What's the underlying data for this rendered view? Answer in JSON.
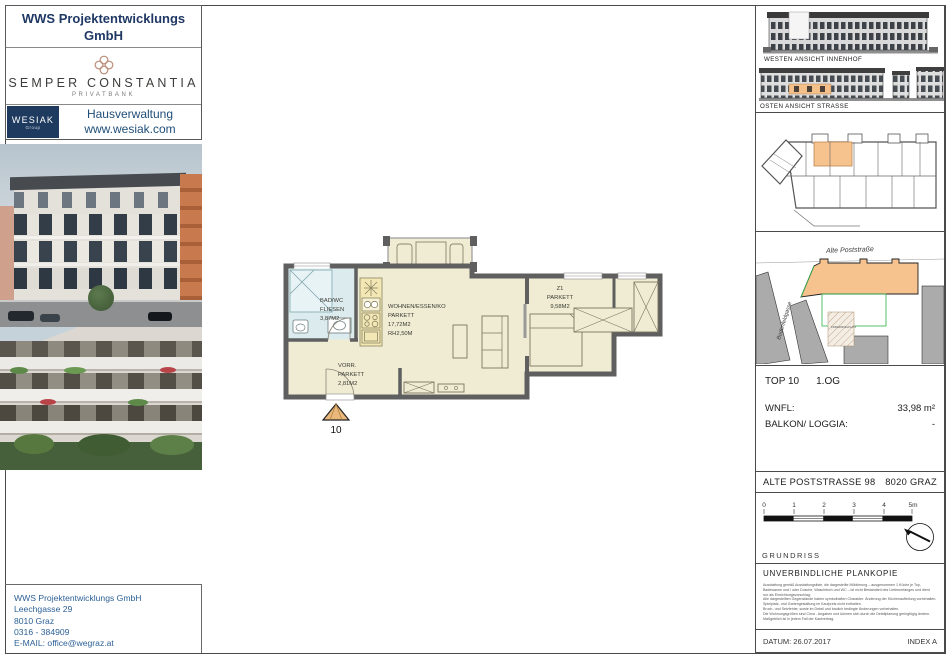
{
  "branding": {
    "wws": [
      "WWS Projektentwicklungs",
      "GmbH"
    ],
    "semper": {
      "name": "SEMPER CONSTANTIA",
      "sub": "PRIVATBANK"
    },
    "wesiak": {
      "box_line1": "WESIAK",
      "box_line2": "Group",
      "line1": "Hausverwaltung",
      "line2": "www.wesiak.com"
    }
  },
  "contact": {
    "lines": [
      "WWS Projektentwicklungs GmbH",
      "Leechgasse 29",
      "8010 Graz",
      "0316 - 384909",
      "E-MAIL: office@wegraz.at"
    ]
  },
  "plan": {
    "living": [
      "WOHNEN/ESSEN/KO",
      "PARKETT",
      "17,72M2",
      "RH2,50M"
    ],
    "room1": [
      "Z1",
      "PARKETT",
      "9,58M2"
    ],
    "bath": [
      "BAD/WC",
      "FLIESEN",
      "3,87M2"
    ],
    "hall": [
      "VORR.",
      "PARKETT",
      "2,81M2"
    ],
    "unit_number": "10"
  },
  "sidebar": {
    "elevation_west_label": "WESTEN ANSICHT INNENHOF",
    "elevation_east_label": "OSTEN ANSICHT STRASSE",
    "siteplan": {
      "street_top": "Alte Poststraße",
      "street_left": "Bodenfeldgasse",
      "playground": "KINDERSPIELPLATZ"
    },
    "unit_info": {
      "top_label": "TOP 10",
      "floor_label": "1.OG",
      "wnfl_label": "WNFL:",
      "wnfl_value": "33,98 m²",
      "balcony_label": "BALKON/ LOGGIA:",
      "balcony_value": "-"
    },
    "project_address": {
      "street": "ALTE POSTSTRASSE 98",
      "city": "8020 GRAZ"
    },
    "scalebar": {
      "labels": [
        "0",
        "1",
        "2",
        "3",
        "4",
        "5m"
      ],
      "drawing_type": "GRUNDRISS"
    },
    "disclaimer": {
      "title": "UNVERBINDLICHE PLANKOPIE",
      "lines": [
        "Ausstattung gemäß Ausstattungsliste, die dargestellte Möblierung – ausgenommen 1 Küche je Top,",
        "Badewanne und / oder Dusche, Waschtisch und WC – ist nicht Bestandteil des Lieferumfanges und dient",
        "nur als Einrichtungsvorschlag.",
        "Alle dargestellten Gegenstände haben symbolhaften Charakter. Änderung der Küchenaufteilung vorbehalten.",
        "Spielplatz- und Gartengestaltung im Kaufpreis nicht enthalten.",
        "Bruch- und Setzfehler, sowie im Detail und baulich bedingte Änderungen vorbehalten.",
        "Die Wohnungsgrößen sind Circa - Angaben und können sich durch die Detailplanung geringfügig ändern.",
        "Maßgeblich ist in jedem Fall der Kaufvertrag."
      ]
    },
    "footer": {
      "date": "DATUM: 26.07.2017",
      "index": "INDEX A"
    }
  },
  "colors": {
    "navy": "#1f3864",
    "link_blue": "#2d6196",
    "logo_copper": "#b98a76",
    "unit_orange": "#f6c28e",
    "plan_floor": "#efecd3",
    "bath_blue": "#dcecee",
    "kitchen_yellow": "#f3e8b5",
    "site_green": "#2eb34a",
    "wall_gray": "#5f5f5f"
  }
}
